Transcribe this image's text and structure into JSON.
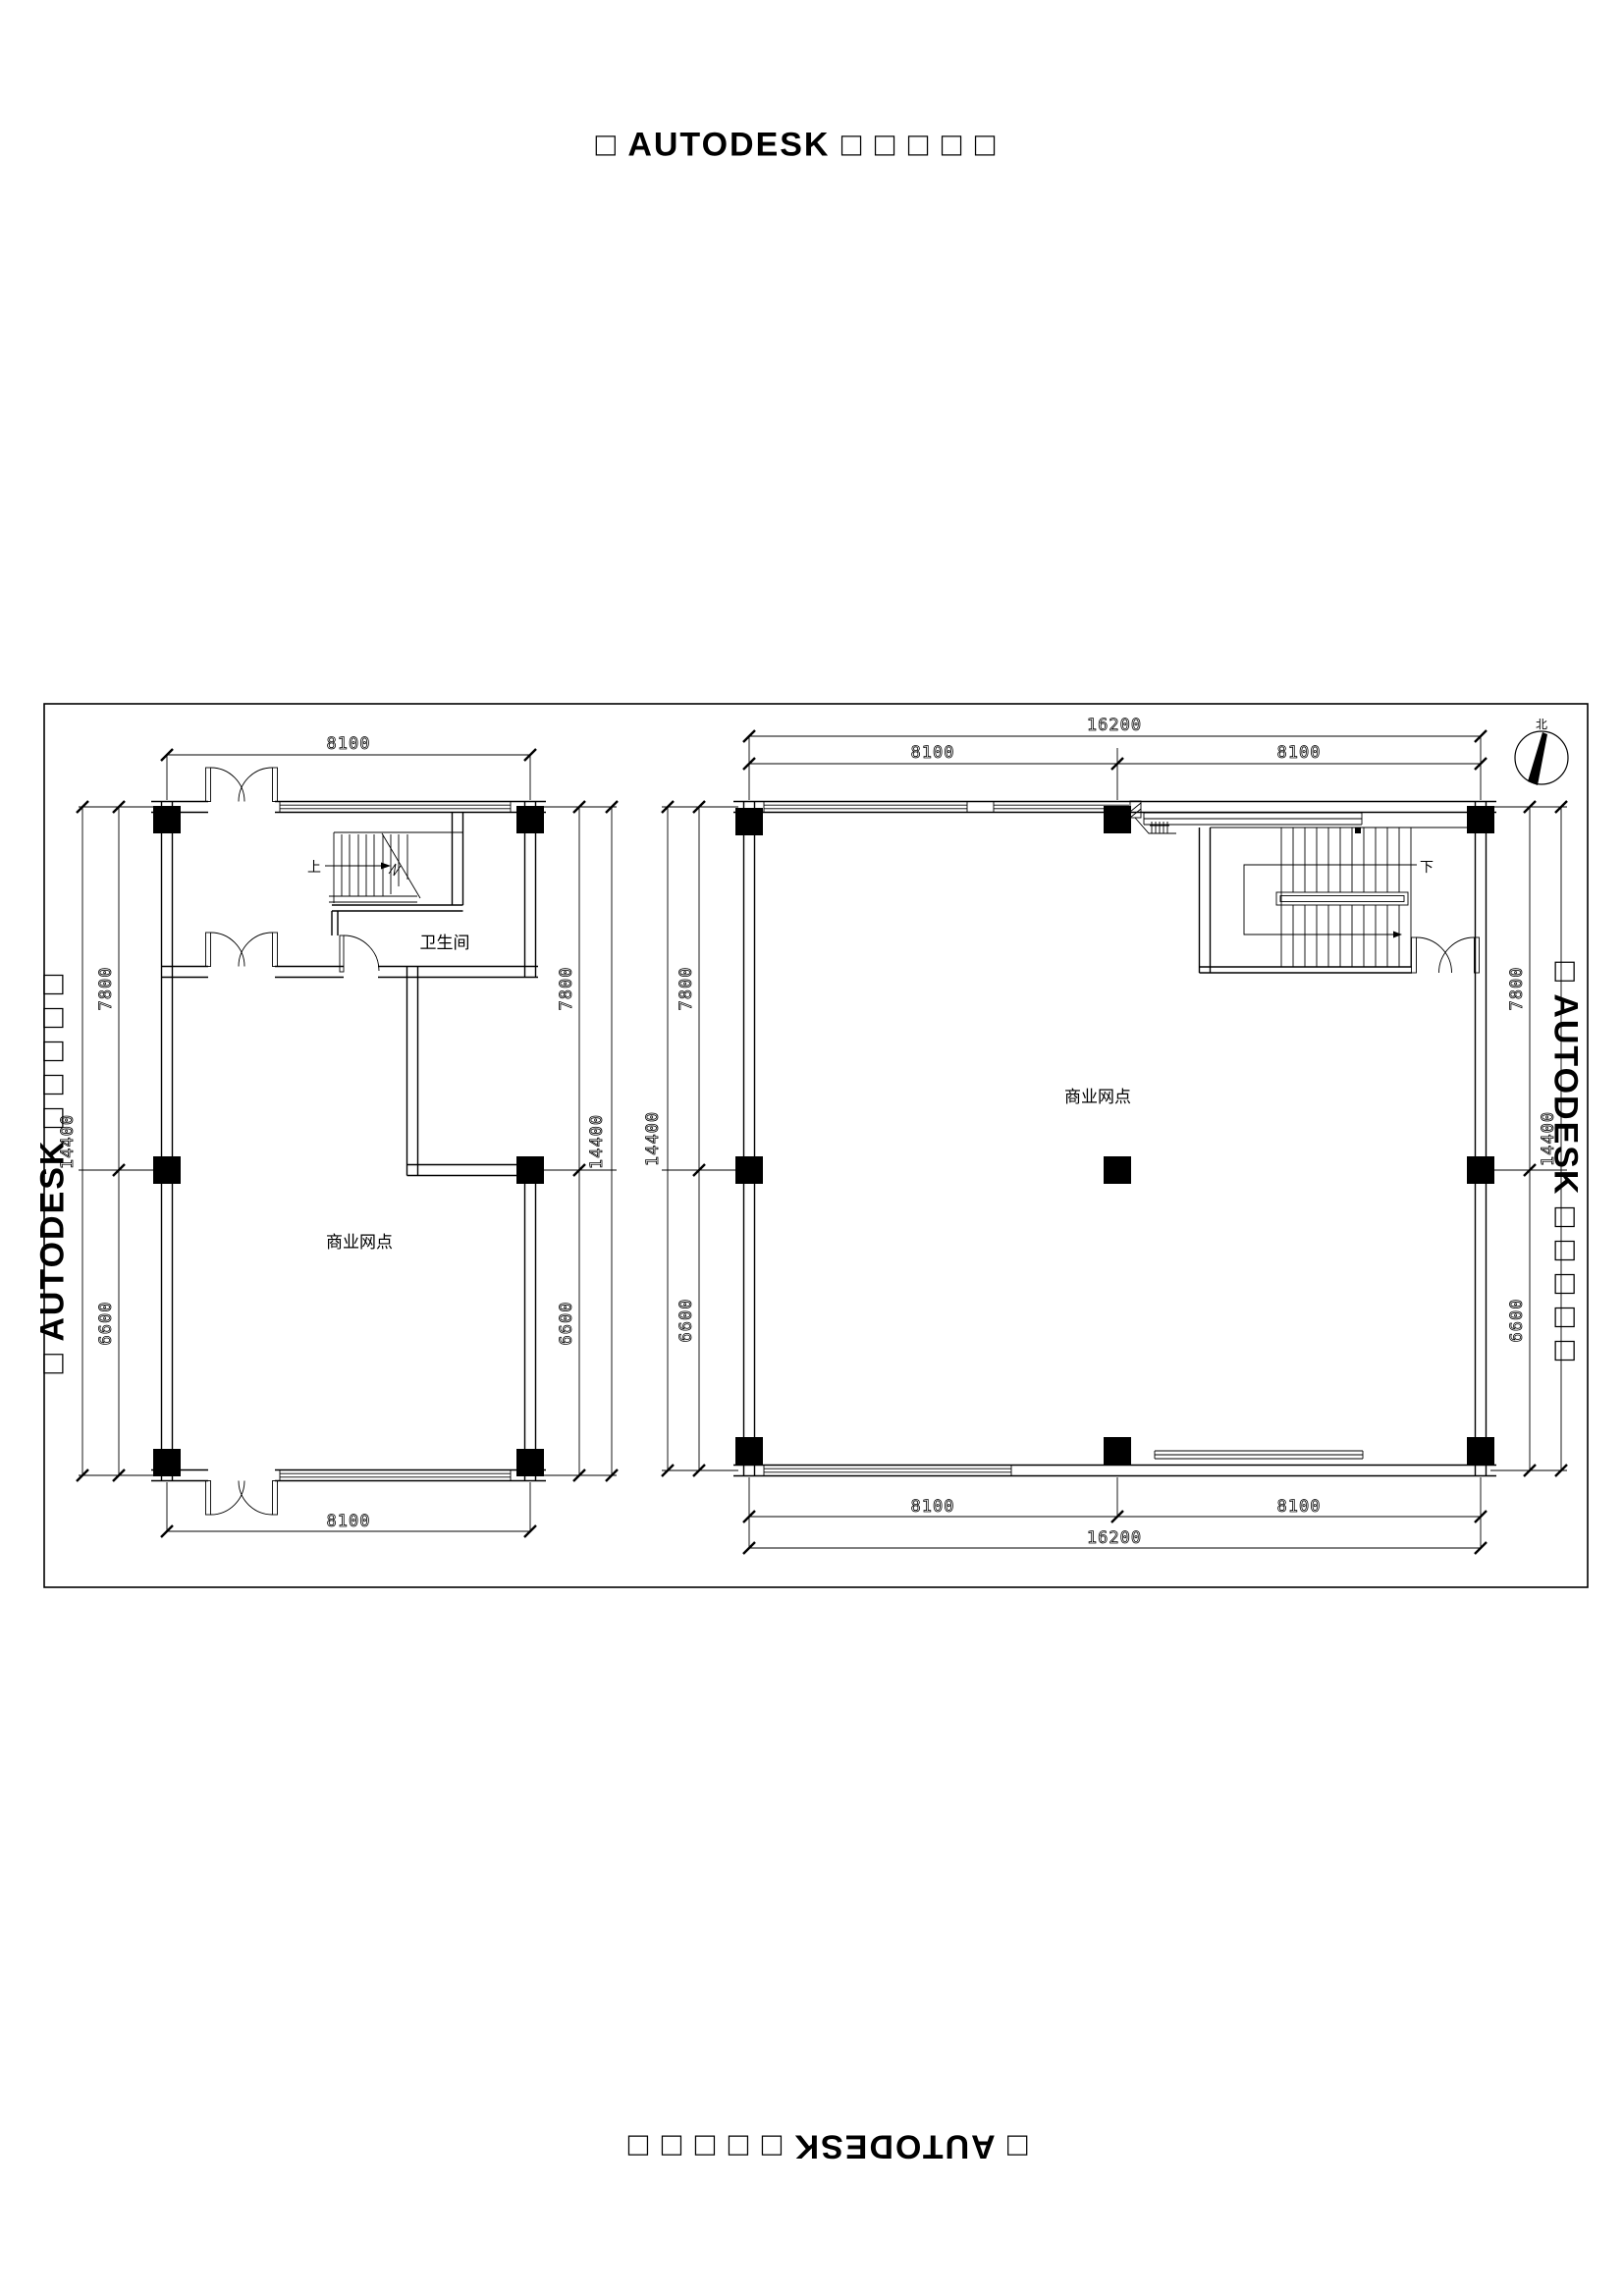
{
  "watermark": {
    "text": "□ AUTODESK □ □ □ □ □"
  },
  "compass": {
    "north_label": "北"
  },
  "plans": {
    "left": {
      "room_label": "商业网点",
      "bathroom_label": "卫生间",
      "stair_direction_label": "上",
      "dimensions": {
        "top_width": "8100",
        "bottom_width": "8100",
        "left_upper": "7800",
        "left_lower": "6600",
        "left_total": "14400",
        "right_upper": "7800",
        "right_lower": "6600",
        "right_total": "14400"
      }
    },
    "right": {
      "room_label": "商业网点",
      "stair_direction_label": "下",
      "dimensions": {
        "top_total": "16200",
        "top_left": "8100",
        "top_right": "8100",
        "bottom_left": "8100",
        "bottom_right": "8100",
        "bottom_total": "16200",
        "left_upper": "7800",
        "left_lower": "6600",
        "left_total": "14400",
        "right_upper": "7800",
        "right_lower": "6600",
        "right_total": "14400"
      }
    }
  }
}
